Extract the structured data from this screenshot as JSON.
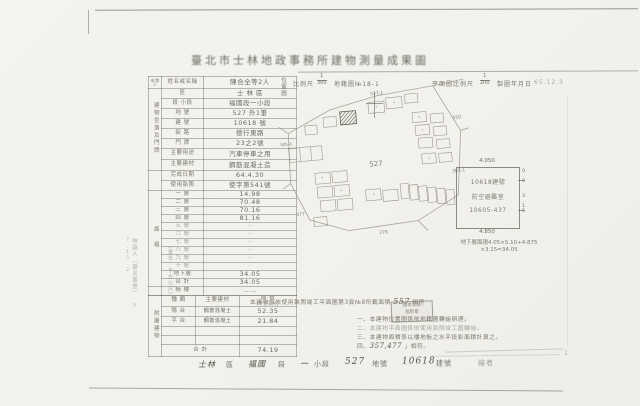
{
  "page": {
    "number": "1"
  },
  "title": "臺北市士林地政事務所建物測量成果圖",
  "header": {
    "map_label": "位置圖",
    "scale_label": "比例尺",
    "scale_num": "1",
    "scale_den": "300",
    "cadastral": "地籍圖№18-1",
    "plan_scale_label": "平面圖比例尺",
    "plan_num": "1",
    "plan_den": "200",
    "date_label": "製圖年月日",
    "date_value": "65.12.3"
  },
  "table": {
    "applicant": {
      "group": "申請人",
      "label": "姓名或名稱",
      "value": "陳合全等2人"
    },
    "location_group": "建物坐落及門牌",
    "info_rows": [
      {
        "label": "區",
        "value": "士 林 區"
      },
      {
        "label": "段 小段",
        "value": "福國段一小段"
      },
      {
        "label": "地 號",
        "value": "527 外1筆"
      },
      {
        "label": "建 號",
        "value": "10618 號"
      },
      {
        "label": "街 路",
        "value": "德行東路"
      },
      {
        "label": "門 牌",
        "value": "23之2號"
      },
      {
        "label": "主要用途",
        "value": "汽車停車之用"
      },
      {
        "label": "主要建材",
        "value": "鋼筋混凝土造"
      }
    ],
    "date_row": {
      "label": "完成日期",
      "value": "64.4.30"
    },
    "license_row": {
      "label": "使用執照",
      "value": "使字第541號"
    },
    "area_group": "面 積",
    "floors": [
      {
        "label": "一 層",
        "value": "14.98"
      },
      {
        "label": "二 層",
        "value": "70.48"
      },
      {
        "label": "三 層",
        "value": "70.16"
      },
      {
        "label": "四 層",
        "value": "81.16"
      },
      {
        "label": "五 層",
        "value": "·"
      },
      {
        "label": "六 層",
        "value": "·"
      },
      {
        "label": "七 層",
        "value": "·"
      },
      {
        "label": "八 層",
        "value": "·"
      },
      {
        "label": "九 層",
        "value": "·"
      },
      {
        "label": "十 層",
        "value": "·"
      },
      {
        "label": "地下層",
        "value": "34.05"
      },
      {
        "label": "合 計",
        "value": "34.05"
      }
    ],
    "arcade_row": {
      "label": "騎 樓",
      "value": "——"
    },
    "unit_note": "（單位:平方公尺）",
    "annex": {
      "group": "附屬建物",
      "col_type": "種 類",
      "col_material": "主要建材",
      "col_area": "面 積",
      "col_area_sub": "(平方公尺)",
      "rows": [
        {
          "type": "陽 台",
          "material": "鋼筋混凝土",
          "area": "52.35"
        },
        {
          "type": "平 台",
          "material": "鋼筋混凝土",
          "area": "21.84"
        },
        {
          "type": "",
          "material": "",
          "area": ""
        },
        {
          "type": "",
          "material": "",
          "area": ""
        }
      ],
      "total_label": "合 計",
      "total_value": "74.19"
    }
  },
  "side_note": {
    "text": "申請人（簽名蓋章）",
    "date": "9 7.15.2"
  },
  "site_plan": {
    "center": "527",
    "top": "527-1",
    "right_top": "550",
    "right": "383-1",
    "left": "905-4",
    "bottom_left": "377",
    "bottom": "278"
  },
  "floor_plan": {
    "dim_top": "4.050",
    "dim_bottom": "4.850",
    "dim_right_a": "0.9",
    "dim_right_b": "3.15",
    "line1": "10618建號",
    "line2": "防空避難室",
    "line3": "10605-437",
    "caption_line1": "地下層面積4.05×5.10+4.875",
    "caption_line2": "×3.15=34.05"
  },
  "statement": {
    "text": "本建物係依使用執照竣工平面圖第3頁№8所載面積",
    "hand": "557",
    "suffix": "相符"
  },
  "stamp": {
    "line1": "謄本發給",
    "line2": "核對章"
  },
  "notes": [
    {
      "no": "一、",
      "text": "本建物位置圖係依地籍圖轉繪辦理。"
    },
    {
      "no": "二、",
      "text": "本建物平面圖係依使用執照竣工圖轉繪。"
    },
    {
      "no": "三、",
      "text": "本建物面積係以樓地板之水平投影面積計算之。"
    },
    {
      "no": "四、",
      "text": "",
      "hand": "357,477",
      "suffix": "」相符。"
    }
  ],
  "footer": {
    "p0": "士林",
    "p1": "區",
    "p2": "福國",
    "p3": "段",
    "p4": "一",
    "p5": "小段",
    "p6": "527",
    "p7": "地號",
    "p8": "10618",
    "p9": "建號",
    "p10": "繪者"
  }
}
